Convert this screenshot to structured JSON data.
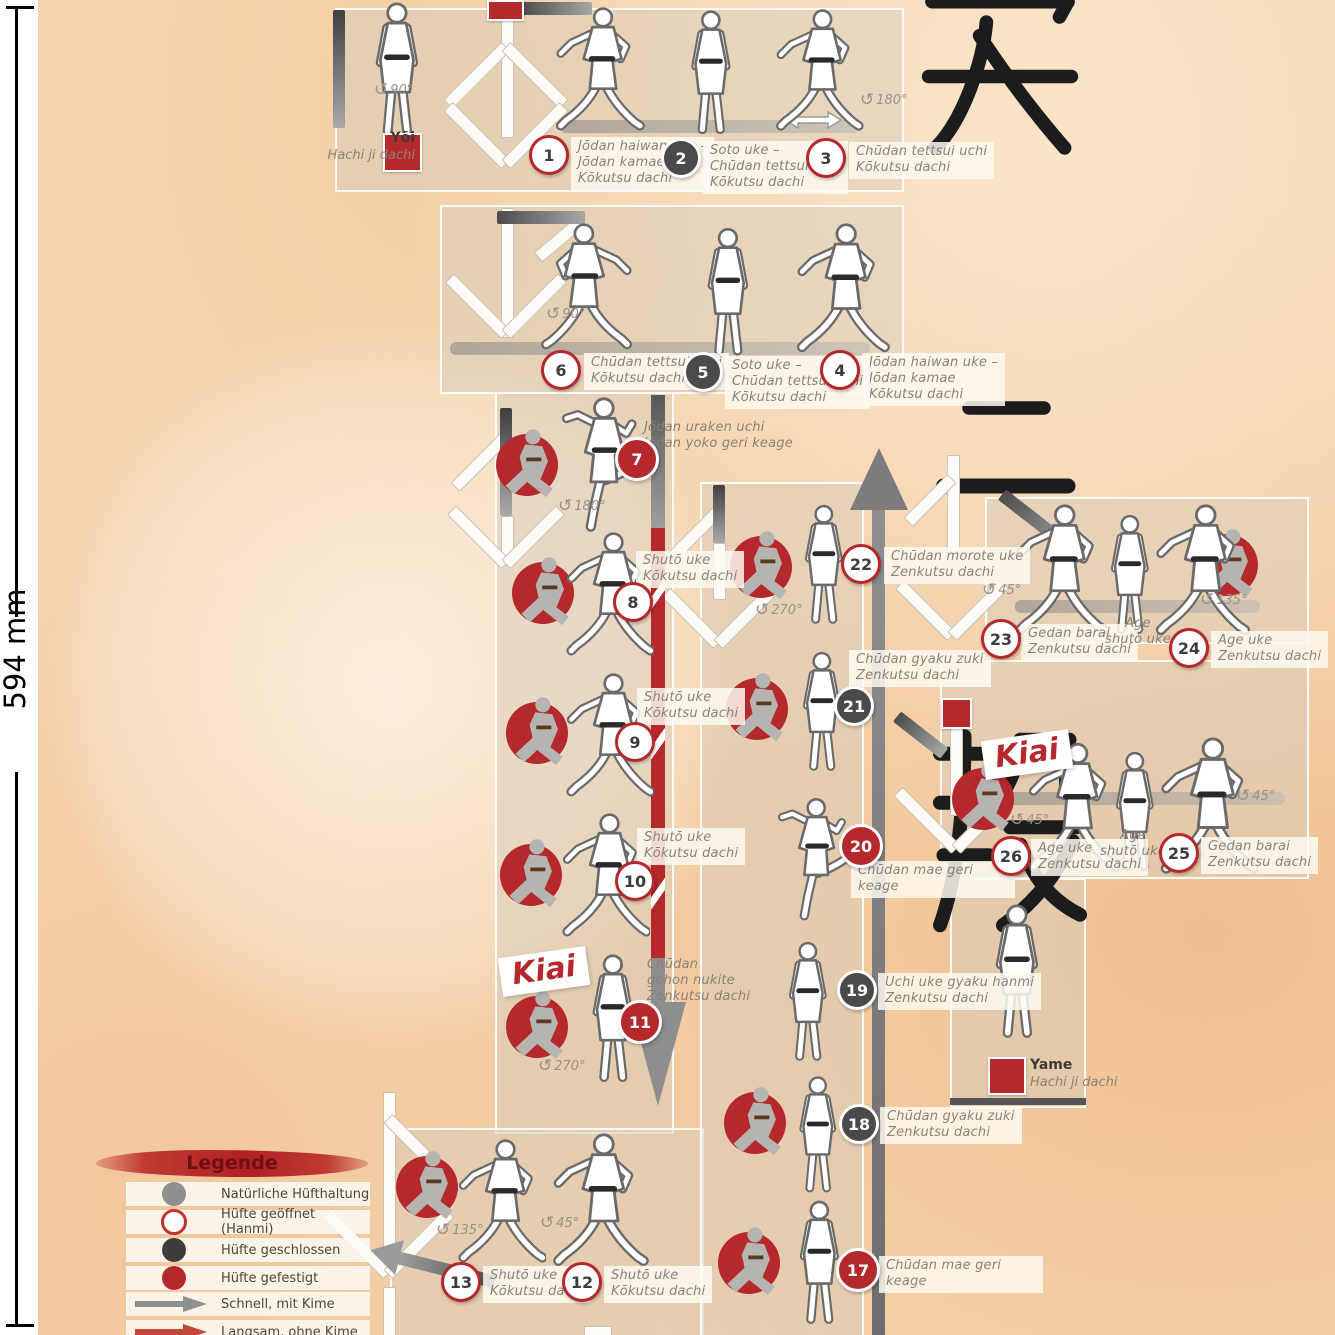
{
  "ruler": {
    "label": "594 mm"
  },
  "kanji": [
    "安",
    "二",
    "段"
  ],
  "icons": {
    "rotate_ccw": "↺"
  },
  "kiai": "Kiai",
  "start": {
    "name": "Yōi",
    "stance": "Hachi ji dachi"
  },
  "end": {
    "name": "Yame",
    "stance": "Hachi ji dachi"
  },
  "steps": [
    {
      "num": 1,
      "type": "open",
      "lines": [
        "Jōdan haiwan uke –",
        "Jōdan kamae",
        "Kōkutsu dachi"
      ]
    },
    {
      "num": 2,
      "type": "closed",
      "lines": [
        "Soto uke –",
        "Chūdan tettsui uchi",
        "Kōkutsu dachi"
      ]
    },
    {
      "num": 3,
      "type": "open",
      "lines": [
        "Chūdan tettsui uchi",
        "Kōkutsu dachi"
      ]
    },
    {
      "num": 4,
      "type": "open",
      "lines": [
        "Jōdan haiwan uke –",
        "Jōdan kamae",
        "Kōkutsu dachi"
      ]
    },
    {
      "num": 5,
      "type": "closed",
      "lines": [
        "Soto uke –",
        "Chūdan tettsui uchi",
        "Kōkutsu dachi"
      ]
    },
    {
      "num": 6,
      "type": "open",
      "lines": [
        "Chūdan tettsui uchi",
        "Kōkutsu dachi"
      ]
    },
    {
      "num": 7,
      "type": "red",
      "lines": [
        "Jōdan uraken uchi",
        "Jōdan yoko geri keage"
      ]
    },
    {
      "num": 8,
      "type": "open",
      "lines": [
        "Shutō uke",
        "Kōkutsu dachi"
      ]
    },
    {
      "num": 9,
      "type": "open",
      "lines": [
        "Shutō uke",
        "Kōkutsu dachi"
      ]
    },
    {
      "num": 10,
      "type": "open",
      "lines": [
        "Shutō uke",
        "Kōkutsu dachi"
      ]
    },
    {
      "num": 11,
      "type": "red",
      "lines": [
        "Chūdan",
        "gohon nukite",
        "Zenkutsu dachi"
      ]
    },
    {
      "num": 12,
      "type": "open",
      "lines": [
        "Shutō uke",
        "Kōkutsu dachi"
      ]
    },
    {
      "num": 13,
      "type": "open",
      "lines": [
        "Shutō uke",
        "Kōkutsu dachi"
      ]
    },
    {
      "num": 17,
      "type": "red",
      "lines": [
        "Chūdan mae geri keage"
      ]
    },
    {
      "num": 18,
      "type": "closed",
      "lines": [
        "Chūdan gyaku zuki",
        "Zenkutsu dachi"
      ]
    },
    {
      "num": 19,
      "type": "closed",
      "lines": [
        "Uchi uke gyaku hanmi",
        "Zenkutsu dachi"
      ]
    },
    {
      "num": 20,
      "type": "red",
      "lines": [
        "Chūdan mae geri keage"
      ]
    },
    {
      "num": 21,
      "type": "closed",
      "lines": [
        "Chūdan gyaku zuki",
        "Zenkutsu dachi"
      ]
    },
    {
      "num": 22,
      "type": "open",
      "lines": [
        "Chūdan morote uke",
        "Zenkutsu dachi"
      ]
    },
    {
      "num": 23,
      "type": "open",
      "lines": [
        "Gedan barai",
        "Zenkutsu dachi"
      ]
    },
    {
      "num": 24,
      "type": "open",
      "lines": [
        "Age uke",
        "Zenkutsu dachi"
      ]
    },
    {
      "num": 25,
      "type": "open",
      "lines": [
        "Gedan barai",
        "Zenkutsu dachi"
      ]
    },
    {
      "num": 26,
      "type": "open",
      "lines": [
        "Age uke",
        "Zenkutsu dachi"
      ]
    }
  ],
  "sub_labels": [
    {
      "lines": [
        "Age",
        "shutō uke"
      ]
    },
    {
      "lines": [
        "Age",
        "shutō uke"
      ]
    }
  ],
  "badges": [
    "90°",
    "180°",
    "90°",
    "180°",
    "270°",
    "270°",
    "45°",
    "135°",
    "45°",
    "135°",
    "45°",
    "45°"
  ],
  "legend": {
    "title": "Legende",
    "items": [
      {
        "symbol": "gray-dot",
        "label": "Natürliche Hüfthaltung"
      },
      {
        "symbol": "open-dot",
        "label": "Hüfte geöffnet (Hanmi)"
      },
      {
        "symbol": "dark-dot",
        "label": "Hüfte geschlossen"
      },
      {
        "symbol": "red-dot",
        "label": "Hüfte gefestigt"
      },
      {
        "symbol": "gray-arrow",
        "label": "Schnell, mit Kime"
      },
      {
        "symbol": "red-arrow",
        "label": "Langsam, ohne Kime"
      }
    ]
  },
  "colors": {
    "accent_red": "#b5282c",
    "dark_step": "#4c4a48",
    "gray": "#8f8f8f",
    "paper": "#f6d6b1"
  }
}
